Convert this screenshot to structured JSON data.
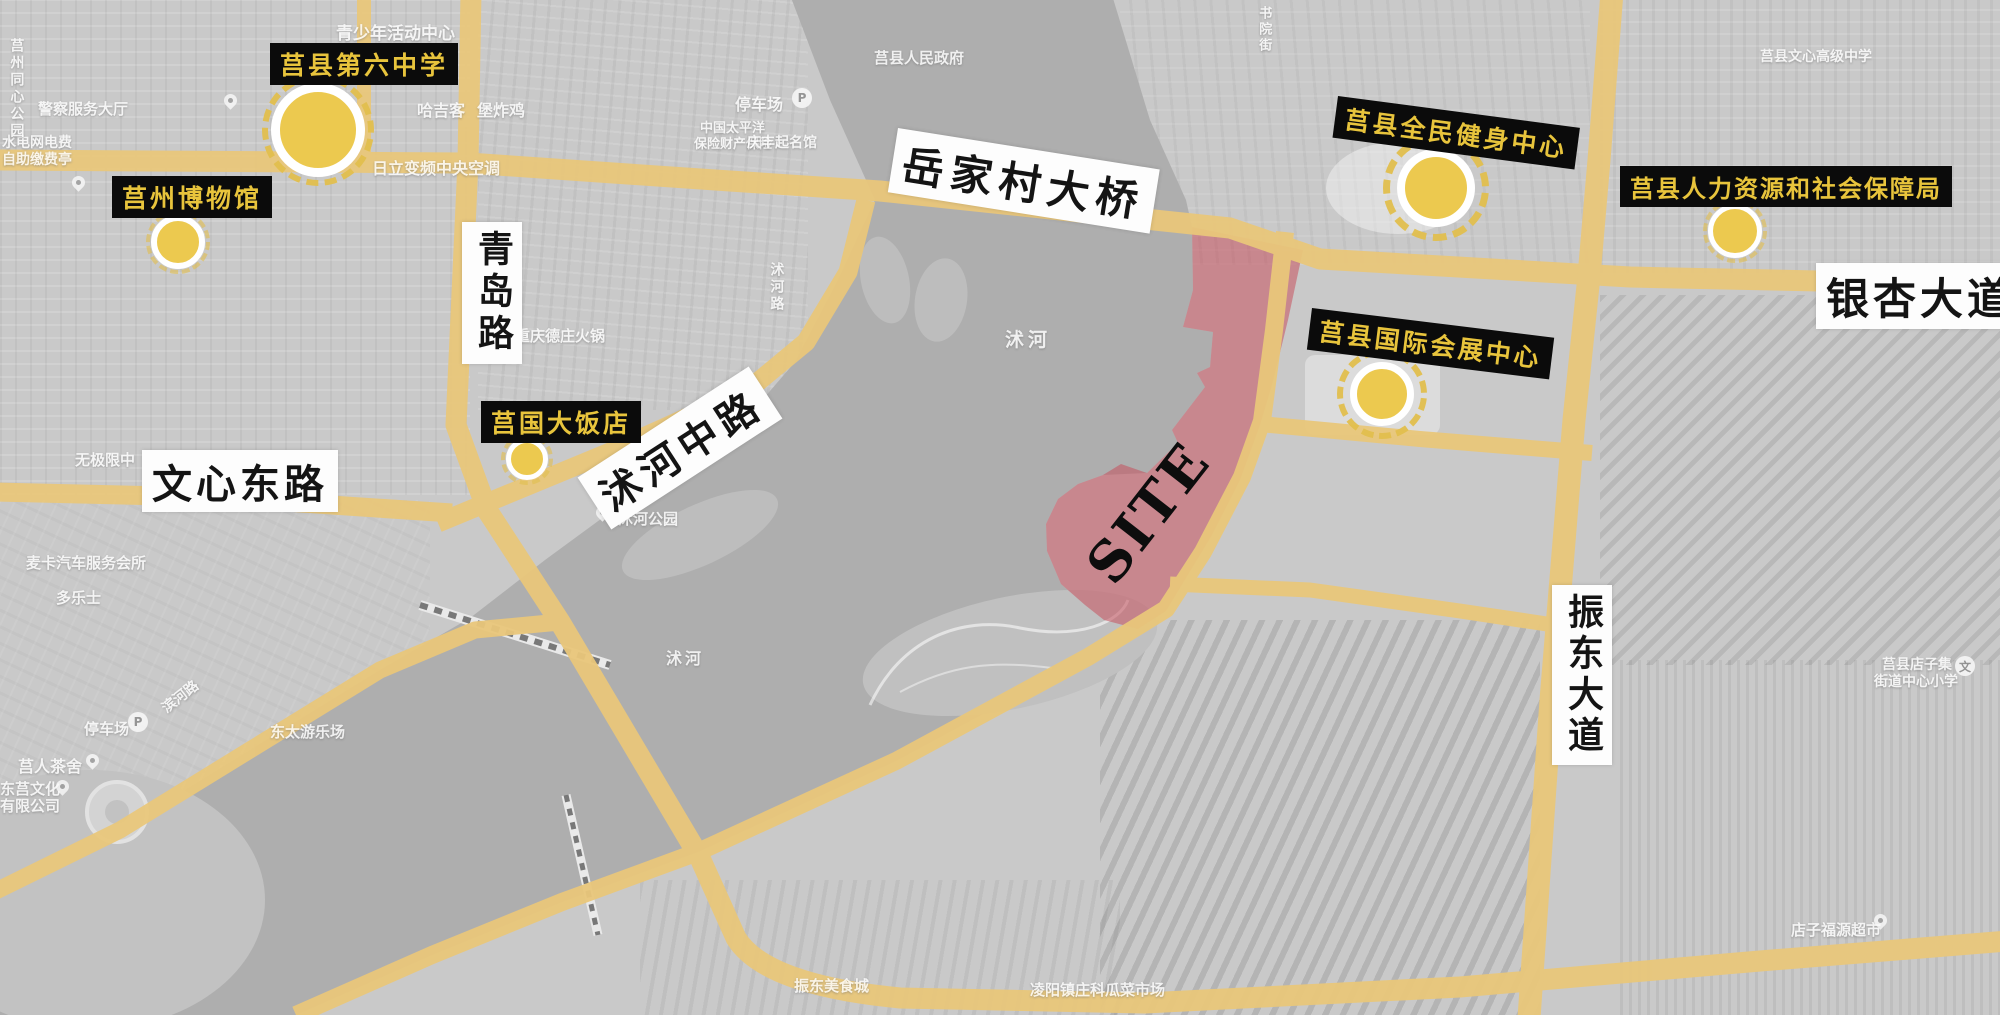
{
  "site": {
    "label": "SITE"
  },
  "colors": {
    "road": "#e9c77b",
    "marker_fill": "#ecc94f",
    "marker_ring": "#e2bf4e",
    "landmark_label_bg": "#0b0b0b",
    "landmark_label_text": "#e8c43c",
    "site_fill": "rgba(198,80,92,0.55)",
    "water": "#aeaeae",
    "land": "#c9c9c9"
  },
  "landmarks": [
    {
      "name": "莒县第六中学"
    },
    {
      "name": "莒州博物馆"
    },
    {
      "name": "莒县全民健身中心"
    },
    {
      "name": "莒县人力资源和社会保障局"
    },
    {
      "name": "莒县国际会展中心"
    },
    {
      "name": "莒国大饭店"
    }
  ],
  "road_labels": [
    {
      "name": "岳家村大桥"
    },
    {
      "name": "银杏大道"
    },
    {
      "name": "青岛路"
    },
    {
      "name": "文心东路"
    },
    {
      "name": "沭河中路"
    },
    {
      "name": "振东大道"
    }
  ],
  "icons": {
    "parking": "P",
    "school": "文"
  },
  "base_labels": [
    {
      "text": "青少年活动中心"
    },
    {
      "text": "莒县人民政府"
    },
    {
      "text": "停车场"
    },
    {
      "text": "哈吉客"
    },
    {
      "text": "堡炸鸡"
    },
    {
      "text": "水电网电费"
    },
    {
      "text": "自助缴费亭"
    },
    {
      "text": "中国太平洋"
    },
    {
      "text": "保险财产保险"
    },
    {
      "text": "庆丰起名馆"
    },
    {
      "text": "日立变频中央空调"
    },
    {
      "text": "重庆德庄火锅"
    },
    {
      "text": "沭河路"
    },
    {
      "text": "沭河"
    },
    {
      "text": "沭河公园"
    },
    {
      "text": "无极限中"
    },
    {
      "text": "麦卡汽车服务会所"
    },
    {
      "text": "多乐士"
    },
    {
      "text": "停车场"
    },
    {
      "text": "滨河路"
    },
    {
      "text": "莒人茶舍"
    },
    {
      "text": "东莒文化"
    },
    {
      "text": "有限公司"
    },
    {
      "text": "东太游乐场"
    },
    {
      "text": "沭河"
    },
    {
      "text": "振东美食城"
    },
    {
      "text": "凌阳镇庄科瓜菜市场"
    },
    {
      "text": "莒县店子集"
    },
    {
      "text": "街道中心小学"
    },
    {
      "text": "店子福源超市"
    },
    {
      "text": "莒州同心公园"
    },
    {
      "text": "莒县文心高级中学"
    },
    {
      "text": "书院街"
    },
    {
      "text": "警察服务大厅"
    }
  ]
}
